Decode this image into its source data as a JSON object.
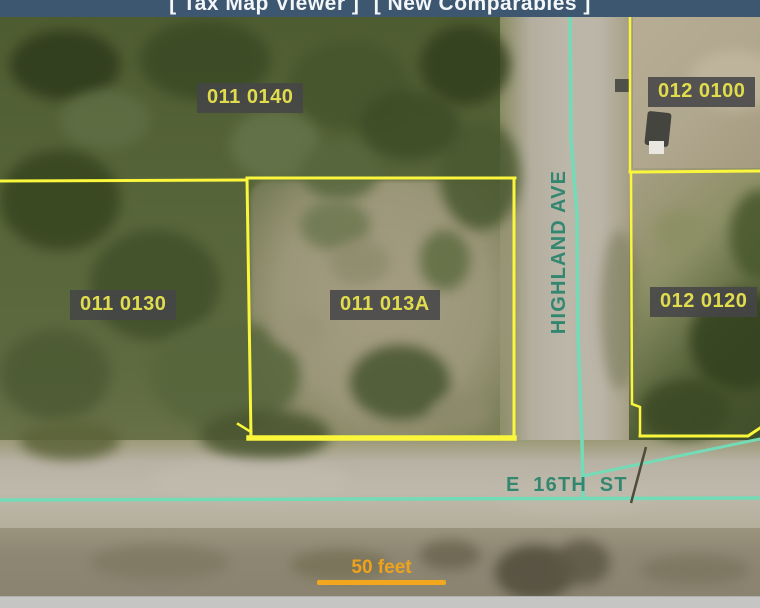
{
  "header": {
    "links": [
      {
        "label": "[ Tax Map Viewer ]"
      },
      {
        "label": "[ New Comparables ]"
      }
    ]
  },
  "map": {
    "parcel_labels": [
      {
        "id": "011-0140",
        "label": "011 0140"
      },
      {
        "id": "012-0100",
        "label": "012 0100"
      },
      {
        "id": "011-0130",
        "label": "011 0130"
      },
      {
        "id": "011-013A",
        "label": "011 013A"
      },
      {
        "id": "012-0120",
        "label": "012 0120"
      }
    ],
    "street_labels": {
      "vertical": "HIGHLAND AVE",
      "horizontal": "E 16TH ST"
    },
    "scale_bar": {
      "label": "50 feet"
    },
    "colors": {
      "header_bg": "#3d5770",
      "parcel_line": "#f9f63b",
      "parcel_label_text": "#e0dc4e",
      "parcel_label_bg": "#464648",
      "street_centerline": "#74dbb7",
      "street_text": "#338771",
      "scale_bar": "#f2a71f"
    }
  }
}
